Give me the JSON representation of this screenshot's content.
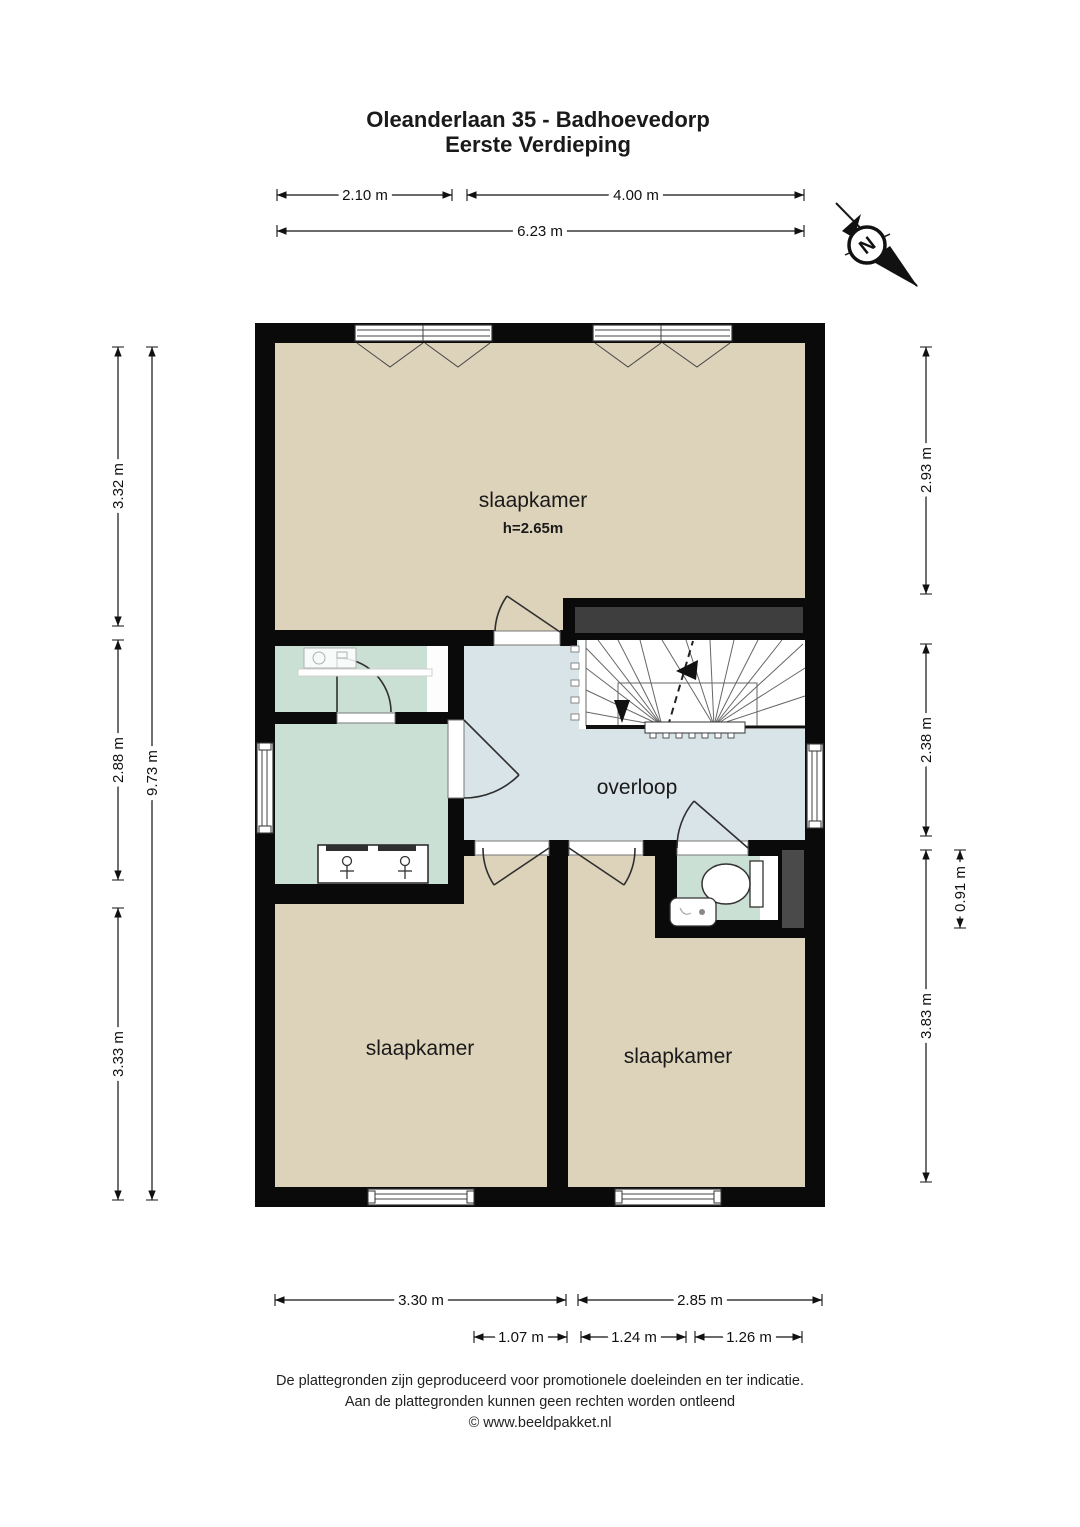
{
  "title": {
    "line1": "Oleanderlaan 35 - Badhoevedorp",
    "line2": "Eerste Verdieping"
  },
  "compass": {
    "north_label": "N"
  },
  "rooms": {
    "bedroom_top": {
      "name": "slaapkamer",
      "ceiling_height": "h=2.65m"
    },
    "landing": {
      "name": "overloop"
    },
    "bedroom_left": {
      "name": "slaapkamer"
    },
    "bedroom_right": {
      "name": "slaapkamer"
    }
  },
  "dimensions": {
    "top": {
      "d1": "2.10 m",
      "d2": "4.00 m",
      "total": "6.23 m"
    },
    "left": {
      "d1": "3.32 m",
      "d2": "2.88 m",
      "d3": "3.33 m",
      "total": "9.73 m"
    },
    "right": {
      "d1": "2.93 m",
      "d2": "2.38 m",
      "d3": "0.91 m",
      "d4": "3.83 m"
    },
    "bottom": {
      "d1": "3.30 m",
      "d2": "2.85 m",
      "s1": "1.07 m",
      "s2": "1.24 m",
      "s3": "1.26 m"
    }
  },
  "footer": {
    "line1": "De plattegronden zijn geproduceerd voor promotionele doeleinden en ter indicatie.",
    "line2": "Aan de plattegronden kunnen geen rechten worden ontleend",
    "line3": "© www.beeldpakket.nl"
  },
  "colors": {
    "room_beige": "#ddd2ba",
    "room_green": "#cbe0d4",
    "landing_blue": "#d9e4e8",
    "wall": "#0a0a0a",
    "accent_dark": "#3e3e3e"
  }
}
